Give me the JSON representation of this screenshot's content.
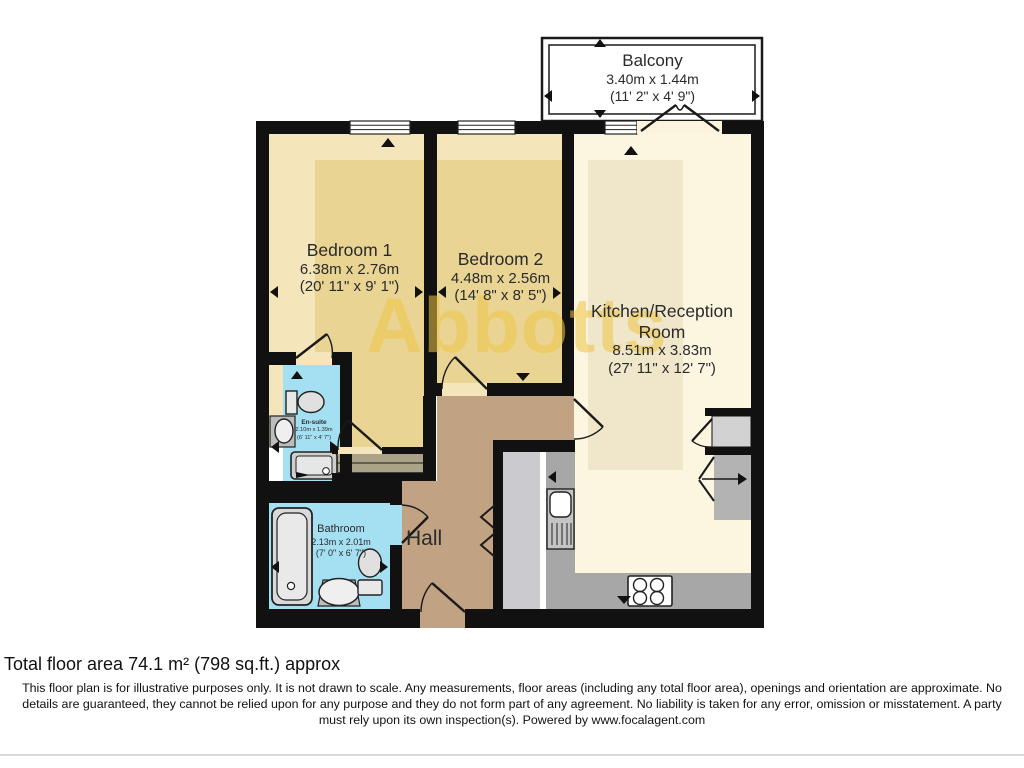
{
  "watermark": "Abbotts",
  "balcony": {
    "name": "Balcony",
    "metric": "3.40m x 1.44m",
    "imperial": "(11' 2\" x 4' 9\")"
  },
  "rooms": {
    "bedroom1": {
      "name": "Bedroom 1",
      "metric": "6.38m x 2.76m",
      "imperial": "(20' 11\" x 9' 1\")"
    },
    "bedroom2": {
      "name": "Bedroom 2",
      "metric": "4.48m x 2.56m",
      "imperial": "(14' 8\" x 8' 5\")"
    },
    "kitchen": {
      "name_line1": "Kitchen/Reception",
      "name_line2": "Room",
      "metric": "8.51m x 3.83m",
      "imperial": "(27' 11\" x 12' 7\")"
    },
    "ensuite": {
      "name": "En-suite",
      "metric": "2.10m x 1.39m",
      "imperial": "(6' 11\" x 4' 7\")"
    },
    "bathroom": {
      "name": "Bathroom",
      "metric": "2.13m x 2.01m",
      "imperial": "(7' 0\" x 6' 7\")"
    },
    "hall": {
      "name": "Hall"
    }
  },
  "footer": {
    "total_area": "Total floor area 74.1 m² (798 sq.ft.) approx",
    "disclaimer_line1": "This floor plan is for illustrative purposes only. It is not drawn to scale. Any measurements, floor areas (including any total floor area), openings and orientation are approximate. No",
    "disclaimer_line2": "details are guaranteed, they cannot be relied upon for any purpose and they do not form part of any agreement. No liability is taken for any error, omission or misstatement. A party",
    "disclaimer_line3": "must rely upon its own inspection(s). Powered by www.focalagent.com"
  },
  "colors": {
    "wall": "#111111",
    "floor_cream": "#f4e5bb",
    "floor_cream_dark": "#e9d493",
    "kitchen_floor": "#fcf5e0",
    "kitchen_floor_dark": "#f0e7cb",
    "wet_room_blue": "#a5e0f2",
    "hall_tan": "#c1a283",
    "counter_gray": "#a7a7a7",
    "closet_gray": "#cbcbcf",
    "watermark_gold": "#eec646"
  }
}
